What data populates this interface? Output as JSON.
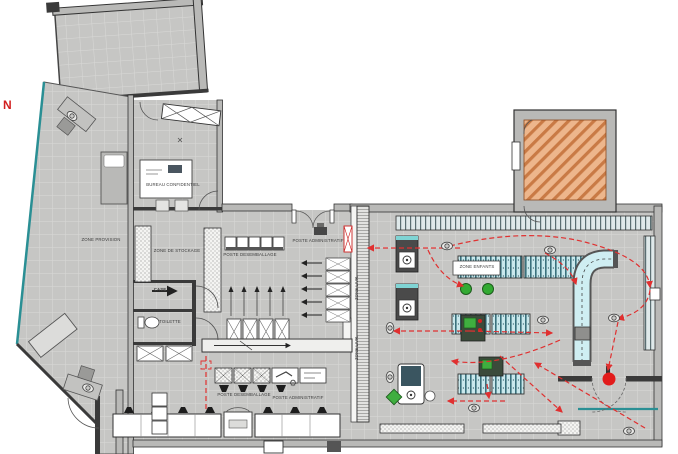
{
  "plan": {
    "labels": {
      "north": "N",
      "zone_provision": "ZONE PROVISION",
      "bureau_confidentiel": "BUREAU CONFIDENTIEL",
      "zone_de_stockage": "ZONE DE STOCKAGE",
      "poste_desemballage_top": "POSTE DESEMBALLAGE",
      "poste_administratif_top": "POSTE ADMINISTRATIF",
      "poste_desemballage_bottom": "POSTE DESEMBALLAGE",
      "poste_administratif_bottom": "POSTE ADMINISTRATIF",
      "zone_enfants": "ZONE ENFANTS",
      "zone_livraison_upper": "ZONE LIVR.",
      "zone_livraison_lower": "ZONE LIVR.",
      "case_room": "CASE",
      "toilette": "TOILETTE"
    },
    "icons": {
      "gear": "⚙"
    },
    "colors": {
      "floor_tile": "#c6c6c4",
      "wall_dark": "#3a3a3a",
      "wall_light": "#b9b9b7",
      "glazing_teal": "#2a8f94",
      "circulation_red": "#e03030",
      "entry_marker_red": "#e21b1b",
      "ramp_orange": "#edb68c",
      "ramp_orange_stripe": "#c97a45",
      "furniture_green": "#3fae3f",
      "table_blue": "#c9e8ec"
    }
  }
}
